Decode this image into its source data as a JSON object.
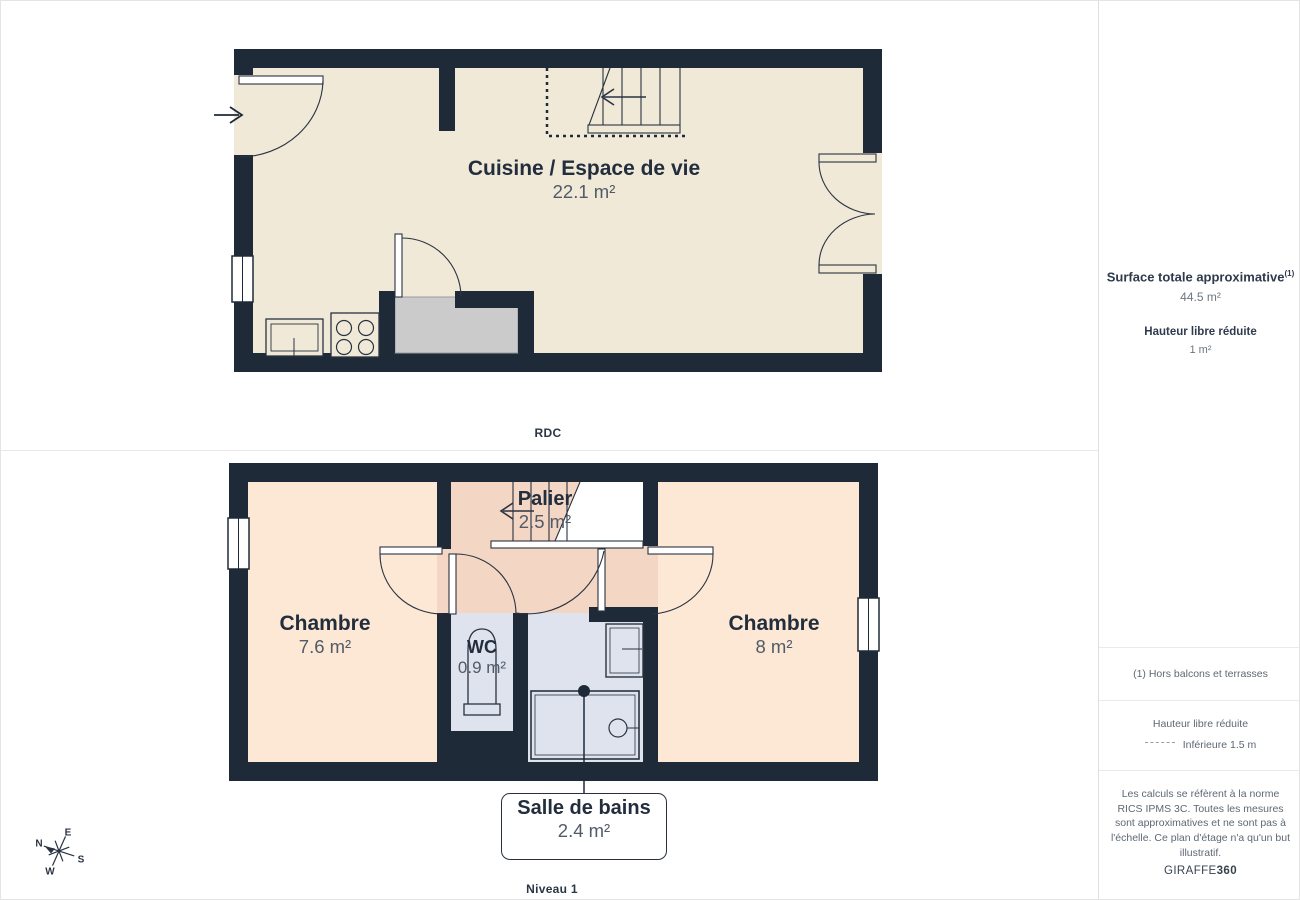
{
  "page": {
    "rdc_caption": "RDC",
    "niveau1_caption": "Niveau 1"
  },
  "rdc": {
    "cuisine": {
      "name": "Cuisine / Espace de vie",
      "area": "22.1 m²"
    }
  },
  "niveau1": {
    "chambre_left": {
      "name": "Chambre",
      "area": "7.6 m²"
    },
    "palier": {
      "name": "Palier",
      "area": "2.5 m²"
    },
    "wc": {
      "name": "WC",
      "area": "0.9 m²"
    },
    "chambre_right": {
      "name": "Chambre",
      "area": "8 m²"
    },
    "salle_de_bains": {
      "name": "Salle de bains",
      "area": "2.4 m²"
    }
  },
  "sidebar": {
    "surface_title": "Surface totale approximative",
    "surface_title_sup": "(1)",
    "surface_value": "44.5 m²",
    "height_title": "Hauteur libre réduite",
    "height_value": "1 m²",
    "footnote": "(1) Hors balcons et terrasses",
    "legend_title": "Hauteur libre réduite",
    "legend_item": "Inférieure 1.5 m",
    "disclaimer": "Les calculs se réfèrent à la norme RICS IPMS 3C. Toutes les mesures sont approximatives et ne sont pas à l'échelle. Ce plan d'étage n'a qu'un but illustratif.",
    "brand_normal": "GIRAFFE",
    "brand_bold": "360"
  },
  "compass": {
    "n": "N",
    "e": "E",
    "s": "S",
    "w": "W"
  },
  "colors": {
    "wall": "#1f2a39",
    "floor_cream": "#f0e9d8",
    "floor_peach": "#fce8d5",
    "floor_pink": "#f3d6c3",
    "floor_blue": "#dfe3ed",
    "closet_gray": "#cbcbcb",
    "line": "#2a3342"
  }
}
